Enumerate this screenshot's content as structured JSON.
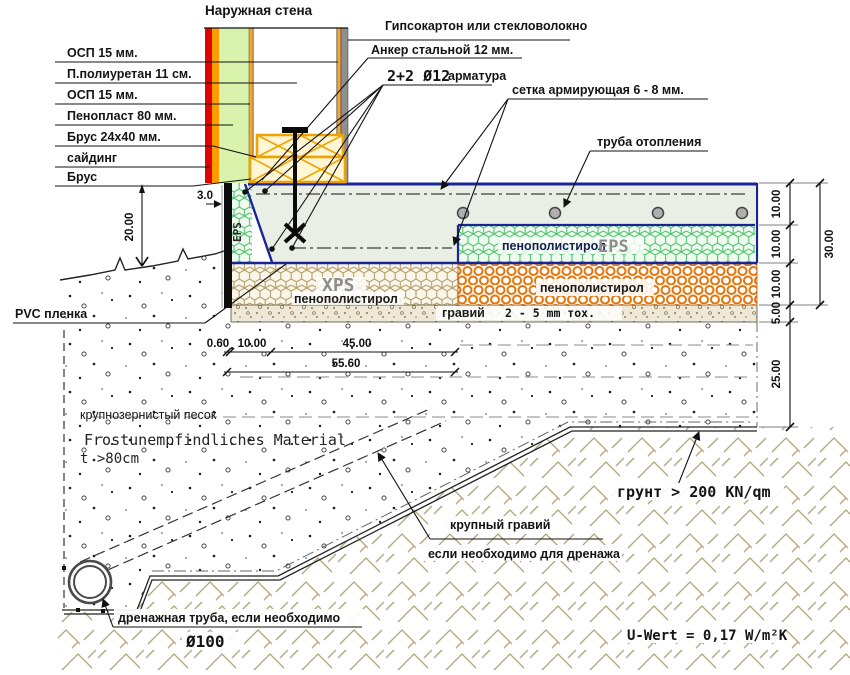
{
  "palette": {
    "slab_border_navy": "#1b2496",
    "wall_red": "#e00505",
    "wall_orange": "#ff9d00",
    "wall_green": "#d9f3ac",
    "beam_orange": "#f0a400",
    "eps_green": "#52c472",
    "xps_tan": "#b59f6b",
    "pur_orange": "#e2750f",
    "ground_hatch_tan": "#b5a478",
    "gray_strip": "#8f8f8f"
  },
  "top": {
    "wall_title": "Наружная стена",
    "gypsum": "Гипсокартон или стекловолокно",
    "anchor": "Анкер стальной 12 мм.",
    "rebar_code": "2+2 Ø12",
    "rebar_word": "арматура",
    "mesh": "сетка армирующая 6 - 8 мм.",
    "heating_pipe": "труба отопления"
  },
  "wall_labels": [
    "ОСП 15 мм.",
    "П.полиуретан 11 см.",
    "ОСП 15 мм.",
    "Пенопласт 80 мм.",
    "Брус 24x40 мм.",
    "сайдинг",
    "Брус"
  ],
  "layers": {
    "eps_edge": "EPS",
    "eps_text": "пенополистирол",
    "eps_code": "EPS",
    "xps_code": "XPS",
    "xps_text": "пенополистирол",
    "pur_text": "пенополистирол",
    "gravel": "гравий",
    "gravel_size": "2 - 5 mm тох.",
    "pvc": "PVC пленка"
  },
  "dimensions": {
    "wall_height": "20.00",
    "edge": "3.0",
    "b1": "0.60",
    "b2": "10.00",
    "b3": "45.00",
    "b4": "55.60",
    "r1": "10.00",
    "r2": "10.00",
    "r3": "10.00",
    "r4": "5.00",
    "r5": "25.00",
    "r6": "30.00"
  },
  "ground": {
    "sand": "крупнозернистый песок",
    "frost1": "Frostunempfindliches Material",
    "frost2": "t >80cm",
    "coarse_gravel": "крупный гравий",
    "drainage_note": "если необходимо для дренажа",
    "soil": "грунт > 200 KN/qm",
    "drain_pipe": "дренажная труба, если необходимо",
    "pipe_diameter": "Ø100",
    "u_value": "U-Wert = 0,17 W/m²K"
  }
}
